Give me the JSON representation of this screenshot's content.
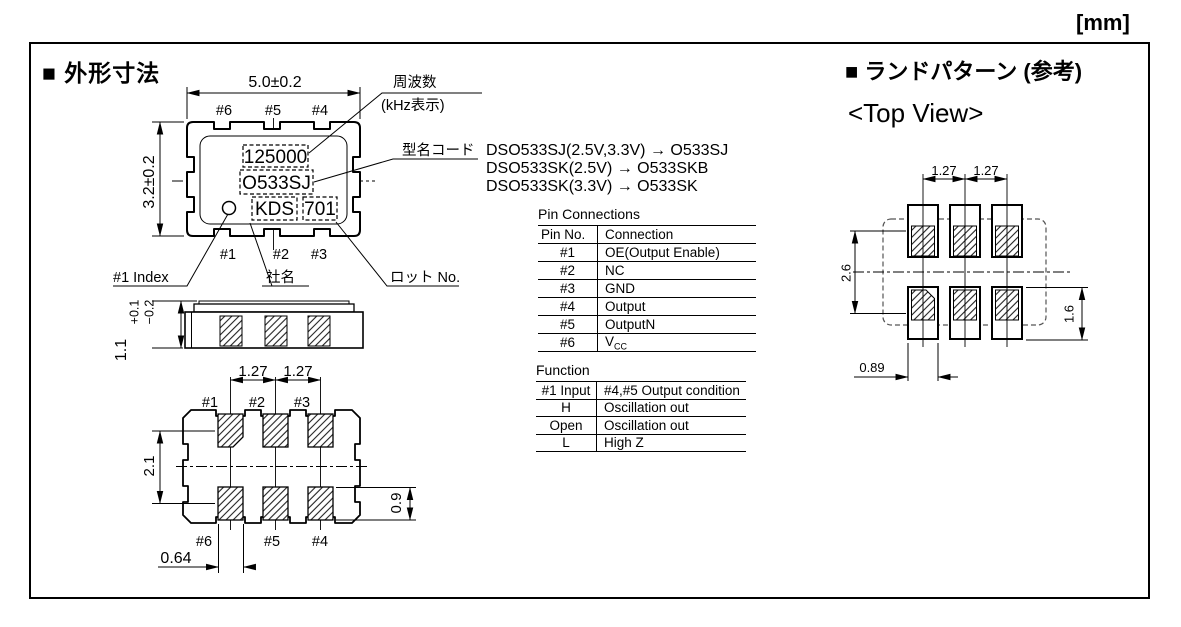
{
  "unit_label": "[mm]",
  "sections": {
    "outline": {
      "title": "■ 外形寸法"
    },
    "land_pattern": {
      "title": "■ ランドパターン (参考)",
      "subtitle": "<Top View>"
    }
  },
  "package_top_view": {
    "dim_width": "5.0±0.2",
    "dim_height": "3.2±0.2",
    "pins_top": [
      "#6",
      "#5",
      "#4"
    ],
    "pins_bottom": [
      "#1",
      "#2",
      "#3"
    ],
    "markings": {
      "frequency": "125000",
      "model_code": "O533SJ",
      "company": "KDS",
      "lot": "701"
    },
    "labels": {
      "frequency": "周波数",
      "frequency_unit": "(kHz表示)",
      "model_code": "型名コード",
      "index": "#1 Index",
      "company": "社名",
      "lot": "ロット No."
    }
  },
  "model_code_map": [
    "DSO533SJ(2.5V,3.3V) → O533SJ",
    "DSO533SK(2.5V) → O533SKB",
    "DSO533SK(3.3V) → O533SK"
  ],
  "side_view": {
    "dim_height": "1.1",
    "tol_plus": "+0.1",
    "tol_minus": "−0.2"
  },
  "bottom_view": {
    "dim_pitch1": "1.27",
    "dim_pitch2": "1.27",
    "dim_row_span": "2.1",
    "dim_pad_h": "0.9",
    "dim_pad_w": "0.64",
    "pins_top": [
      "#1",
      "#2",
      "#3"
    ],
    "pins_bottom": [
      "#6",
      "#5",
      "#4"
    ]
  },
  "land_pattern_view": {
    "dim_pitch1": "1.27",
    "dim_pitch2": "1.27",
    "dim_row_span": "2.6",
    "dim_pad_h": "1.6",
    "dim_pad_w": "0.89"
  },
  "tables": {
    "pin_connections": {
      "title": "Pin Connections",
      "headers": [
        "Pin No.",
        "Connection"
      ],
      "rows": [
        {
          "pin": "#1",
          "conn": "OE(Output Enable)"
        },
        {
          "pin": "#2",
          "conn": "NC"
        },
        {
          "pin": "#3",
          "conn": "GND"
        },
        {
          "pin": "#4",
          "conn": "Output"
        },
        {
          "pin": "#5",
          "conn": "OutputN"
        },
        {
          "pin": "#6",
          "conn": "V",
          "conn_sub": "CC"
        }
      ]
    },
    "function": {
      "title": "Function",
      "headers": [
        "#1 Input",
        "#4,#5 Output condition"
      ],
      "rows": [
        {
          "input": "H",
          "output": "Oscillation out"
        },
        {
          "input": "Open",
          "output": "Oscillation out"
        },
        {
          "input": "L",
          "output": "High Z"
        }
      ]
    }
  }
}
